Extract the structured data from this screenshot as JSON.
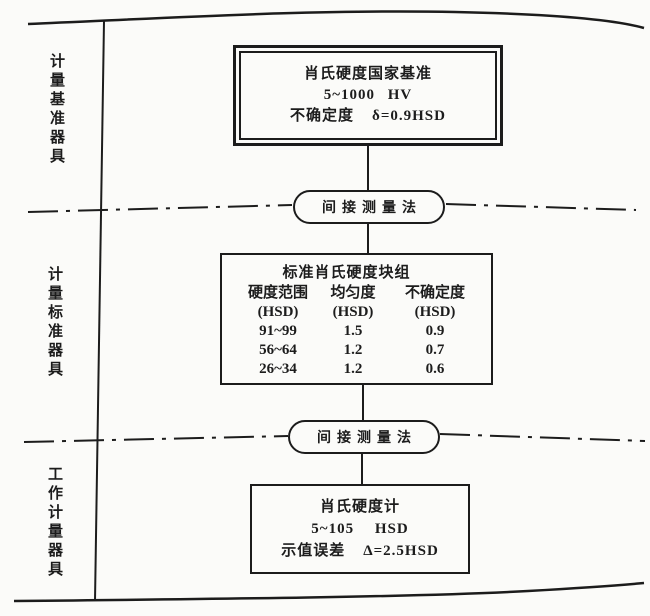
{
  "colors": {
    "ink": "#1c1c1c",
    "paper": "#fbfbf9"
  },
  "side_labels": [
    {
      "label": "计量基准器具"
    },
    {
      "label": "计量标准器具"
    },
    {
      "label": "工作计量器具"
    }
  ],
  "primary_box": {
    "line1": "肖氏硬度国家基准",
    "line2": "5~1000 HV",
    "line3_label": "不确定度",
    "line3_value": "δ=0.9HSD"
  },
  "transfer_method": "间接测量法",
  "standard_box": {
    "title": "标准肖氏硬度块组",
    "columns": [
      "硬度范围",
      "均匀度",
      "不确定度"
    ],
    "units": [
      "(HSD)",
      "(HSD)",
      "(HSD)"
    ],
    "rows": [
      [
        "91~99",
        "1.5",
        "0.9"
      ],
      [
        "56~64",
        "1.2",
        "0.7"
      ],
      [
        "26~34",
        "1.2",
        "0.6"
      ]
    ]
  },
  "working_box": {
    "line1": "肖氏硬度计",
    "line2": "5~105 HSD",
    "line3_label": "示值误差",
    "line3_value": "Δ=2.5HSD"
  }
}
